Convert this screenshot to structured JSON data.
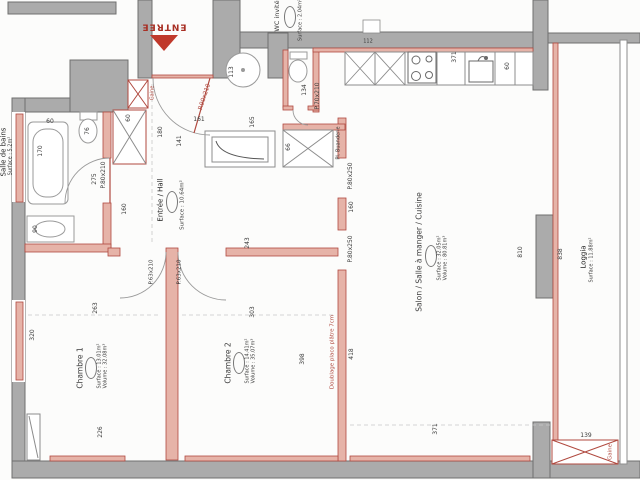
{
  "plan": {
    "entrance_label": "ENTREE",
    "rooms": {
      "bathroom": {
        "name": "Salle de bains",
        "surface": "Surface : 5.2m²"
      },
      "guest_wc": {
        "name": "WC invité",
        "surface": "Surface : 2.04m²"
      },
      "hall": {
        "name": "Entrée / Hall",
        "surface": "Surface : 10.64m²"
      },
      "bedroom1": {
        "name": "Chambre 1",
        "surface": "Surface : 13.01m²",
        "volume": "Volume : 32.08m³"
      },
      "bedroom2": {
        "name": "Chambre 2",
        "surface": "Surface : 14.41m²",
        "volume": "Volume : 35.07m³"
      },
      "living": {
        "name": "Salon / Salle à manger / Cuisine",
        "surface": "Surface : 32.05m²",
        "volume": "Volume : 80.81m³"
      },
      "loggia": {
        "name": "Loggia",
        "surface": "Surface : 11.88m²"
      },
      "laundry_closet": {
        "name": "Pl. Buanderie"
      }
    },
    "doors": {
      "entrance": "P.90x210",
      "bathroom": "P.80x210",
      "wc": "P.70x210",
      "bedroom1": "P.63x210",
      "bedroom2": "P.63x210",
      "living_upper": "P.80x250",
      "living_lower": "P.80x250"
    },
    "annotations": {
      "lining": "Doublage placo plâtre 7cm",
      "duct_top": "Gaine",
      "duct_loggia": "Gaine"
    },
    "dimensions": {
      "tub_length": "170",
      "tub_width": "60",
      "bath_toilet": "76",
      "bath_length": "275",
      "bath_width": "160",
      "bath_closet": "60",
      "bath_vanity": "90",
      "hall_w1": "180",
      "hall_w2": "141",
      "hall_l": "161",
      "heater": "113",
      "lobby_h": "165",
      "wc_depth": "134",
      "duct_shaft": "112",
      "laundry_w": "66",
      "hall_d": "243",
      "wall_between_doors": "160",
      "bed1_top": "263",
      "bed1_left": "320",
      "bed1_bottom": "226",
      "bed2_top": "303",
      "bed2_mid": "398",
      "bed2_right": "418",
      "living_bottom": "371",
      "kitchen_run": "371",
      "kitchen_depth": "60",
      "living_height": "810",
      "loggia_length": "838",
      "loggia_width": "139"
    },
    "colors": {
      "wall": "#ababab",
      "partition_fill": "#e6b3a8",
      "partition_stroke": "#b0493f",
      "accent_red": "#c0392b",
      "line": "#8c8c8c"
    }
  }
}
